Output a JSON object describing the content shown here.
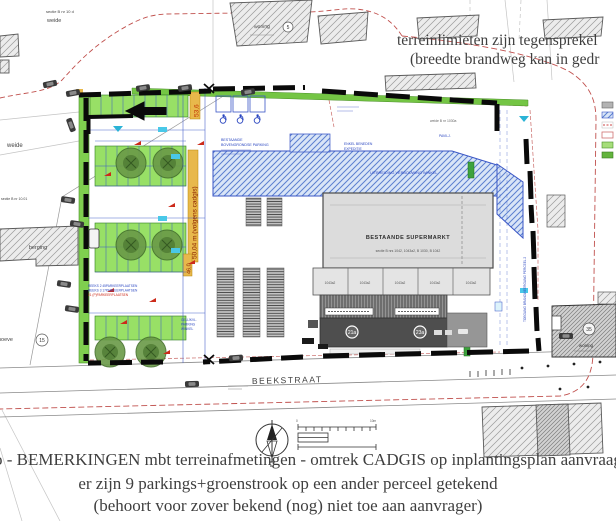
{
  "notes": {
    "top_right": {
      "line1": "terreinlimieten zijn tegensprekel",
      "line2": "(breedte brandweg kan in gedr"
    },
    "bottom": {
      "line1": "o - BEMERKINGEN mbt terreinafmetingen - omtrek CADGIS op inplantingsplan aanvraag",
      "line2": "er zijn 9 parkings+groenstrook op een ander perceel getekend",
      "line3": "(behoort voor zover bekend (nog) niet toe aan aanvrager)"
    }
  },
  "plan": {
    "street": "BEEKSTRAAT",
    "supermarket": {
      "title": "BESTAANDE SUPERMARKT",
      "subtitle": "sectie B nrs 1042, 1043a2, B 1030, B 1042",
      "cell": "1043a2"
    },
    "labels": {
      "sectie_top": "sectie B nr 10 d",
      "weide_top": "weide",
      "weide_left": "weide",
      "sectie_left": "sectie B nr 10.01",
      "berging": "berging",
      "hoeve": "hoeve",
      "woning_top": "woning",
      "woning_right": "woning",
      "weide_mid": "weide B nr 1030a",
      "pavilj": "PAVILJ."
    },
    "badges": {
      "top_house": "5",
      "farm": "15",
      "right_house": "35",
      "dock_a": "21a",
      "dock_b": "23a"
    },
    "dims": {
      "d1": "53,6",
      "d2": "50,04 m (volgens cadgis)",
      "d3": "46,0"
    },
    "annotations": {
      "parking1": "BESTAANDE",
      "parking2": "BOVENGRONDSE PARKING",
      "reeks1": "REEKS 2 45PARKEERPLAATSEN",
      "reeks2": "REEKS 3 17PARKEERPLAATSEN",
      "reeks3": "21 (P)PARKEERPLAATSEN",
      "uitbreiding": "UITBREIDING VERBOUWING WINKEL",
      "enkel1": "ENKEL BENEDEN",
      "enkel2": "EXPEDITIE",
      "gelijk1": "GELIJKVL.",
      "gelijk2": "PARKING",
      "gelijk3": "WINKEL",
      "toegang": "TOEGANG BRANDWEERGANG PERCEEL 2"
    },
    "scale": {
      "zero": "0",
      "ten": "10m"
    },
    "legend_icons": [
      "existing-building-swatch",
      "blue-extension-swatch",
      "red-boundary-swatch",
      "parcel-outline-swatch",
      "light-green-swatch",
      "dark-green-swatch"
    ],
    "colors": {
      "boundary_black": "#0a0a0a",
      "cadgis_red": "#c0504d",
      "extension_blue": "#5b7fd0",
      "stall_green": "#98e066",
      "dim_orange": "#e8b84b"
    }
  }
}
